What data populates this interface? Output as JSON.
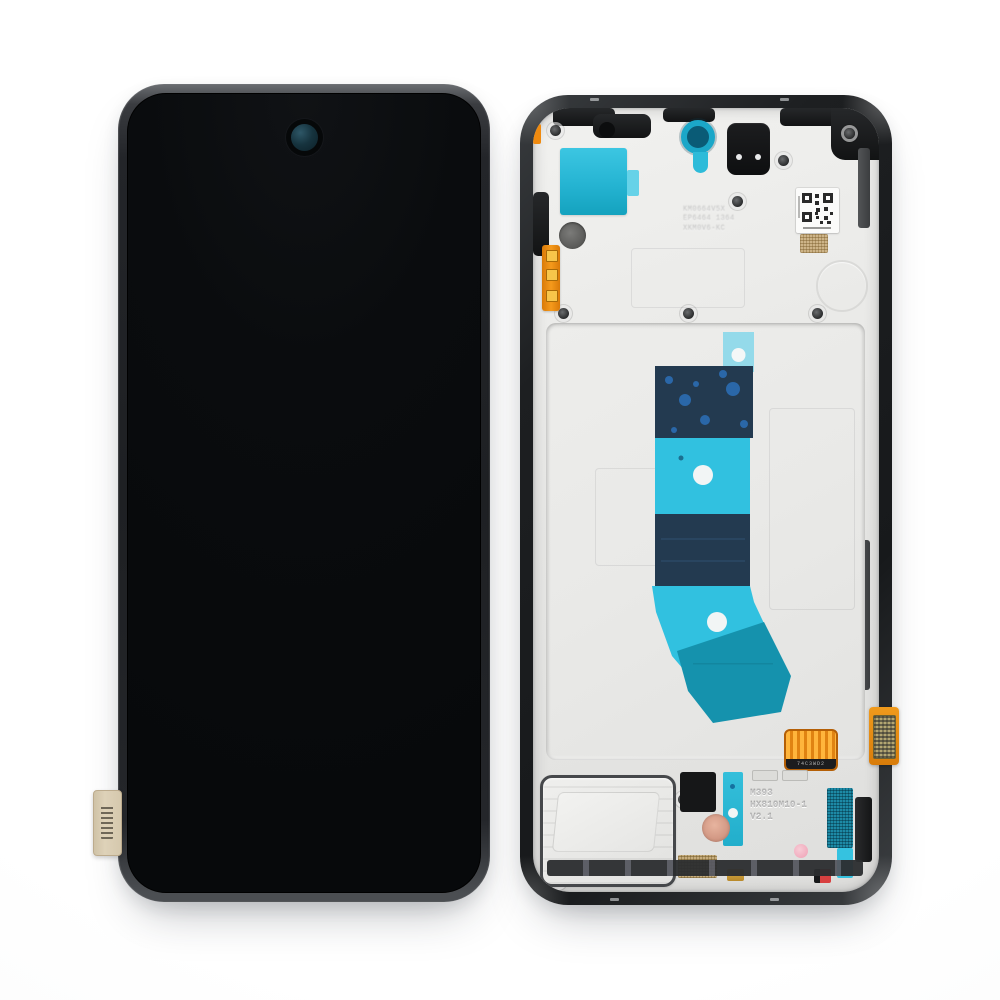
{
  "meta": {
    "alt": "Product photo of a smartphone screen assembly replacement part: front black display (left) and rear mid-frame with adhesive and flex cables (right)"
  },
  "front_assembly": {
    "part_name": "display-front",
    "screen_color": "#0a0c0e",
    "frame_color": "#232529",
    "camera_hole_color": "#16333e",
    "side_sticker_color": "#d5c8ad"
  },
  "back_assembly": {
    "part_name": "mid-frame-rear",
    "panel_color": "#e9e9e7",
    "stamp_top": {
      "line1": "KM0664V5X",
      "line2": "EP6464  1364",
      "line3": "XKM0V6-KC"
    },
    "stamp_bottom": {
      "line1": "M393",
      "line2": "HX810M10-1",
      "line3": "V2.1"
    },
    "flex_band_text": "74C3WD2",
    "adhesive_colors": {
      "navy": "#233a50",
      "cyan": "#31c1e0",
      "teal": "#1592ad",
      "tab": "#8cd8e9"
    },
    "accent_colors": {
      "orange_flex": "#ef8a0f",
      "gold_mesh": "#cdb488",
      "teal_mesh": "#1d8aa6",
      "copper_coil": "#d9a18e",
      "pink_dot": "#f3bcc9"
    }
  }
}
